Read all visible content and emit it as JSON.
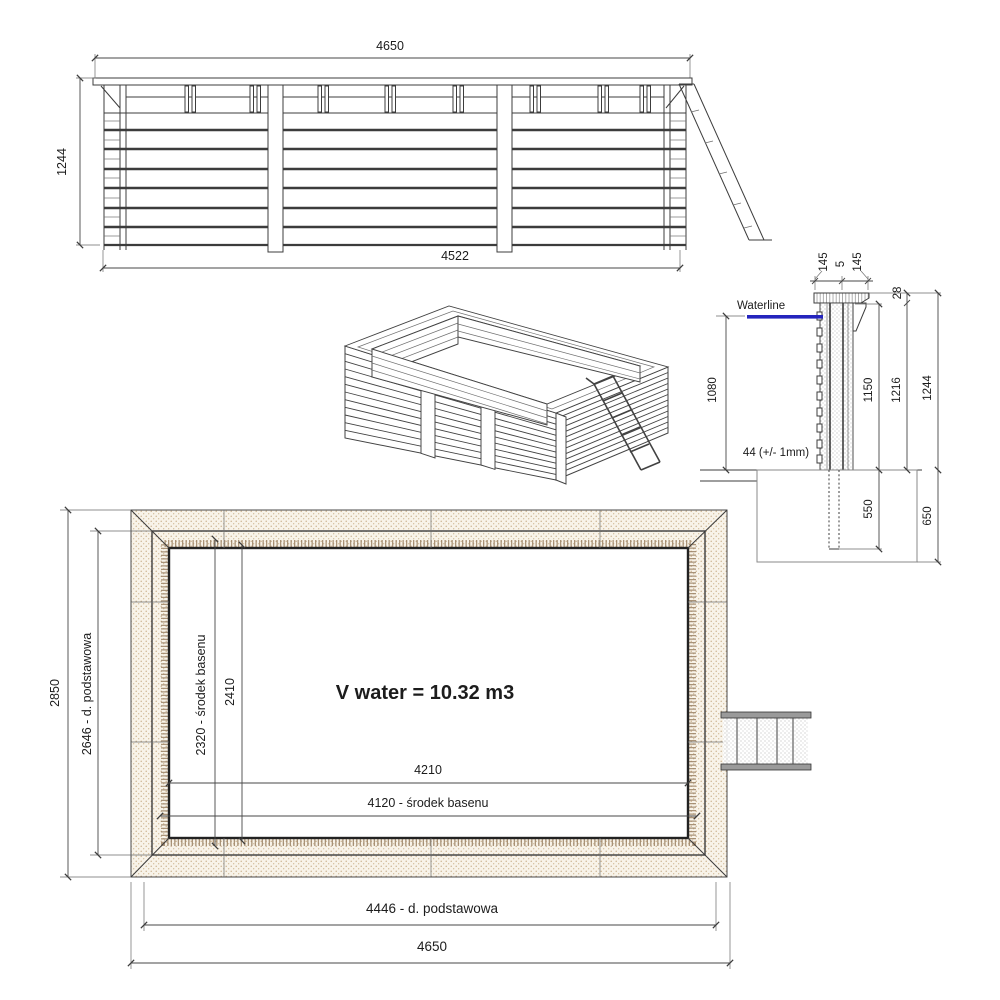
{
  "elevation": {
    "dim_top": "4650",
    "dim_left": "1244",
    "dim_bottom": "4522"
  },
  "section": {
    "dim_cap_left": "145",
    "dim_cap_gap": "5",
    "dim_cap_right": "145",
    "dim_cap_thickness": "28",
    "waterline_label": "Waterline",
    "dim_water_depth": "1080",
    "dim_wall_thickness": "44 (+/- 1mm)",
    "dim_wall_height": "1150",
    "dim_wall_with_cap": "1216",
    "dim_total_height": "1244",
    "dim_buried_depth": "550",
    "dim_footing_depth": "650"
  },
  "plan": {
    "dim_outer_height": "2850",
    "dim_base_height": "2646 - d. podstawowa",
    "dim_center_height": "2320 - środek basenu",
    "dim_inner_height": "2410",
    "volume_label": "V water = 10.32 m3",
    "dim_inner_width": "4210",
    "dim_center_width": "4120 - środek basenu",
    "dim_base_width": "4446 - d. podstawowa",
    "dim_outer_width": "4650"
  },
  "colors": {
    "waterline_blue": "#2424bd",
    "wood_stipple": "#bfa178",
    "line": "#3c3c3c"
  }
}
